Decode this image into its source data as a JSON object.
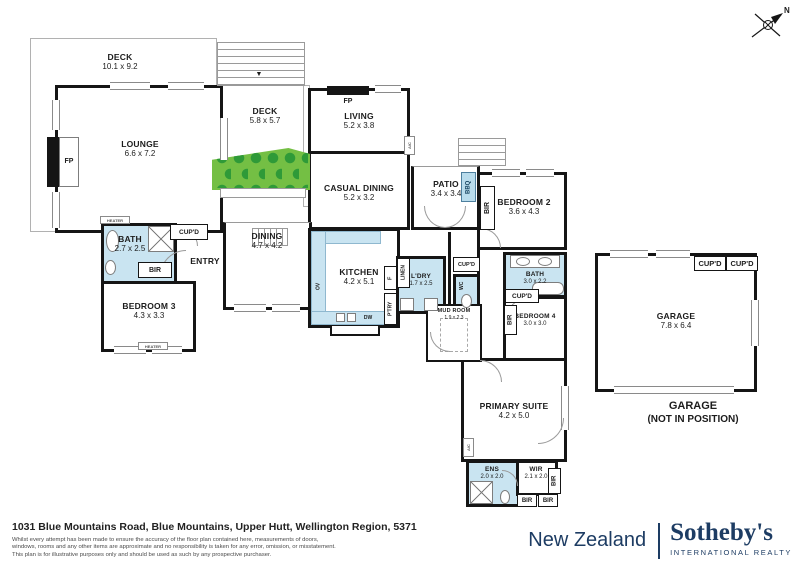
{
  "compass": {
    "north_label": "N"
  },
  "rooms": {
    "deck_main": {
      "name": "DECK",
      "dims": "10.1 x 9.2"
    },
    "lounge": {
      "name": "LOUNGE",
      "dims": "6.6 x 7.2"
    },
    "deck_upper": {
      "name": "DECK",
      "dims": "5.8 x 5.7"
    },
    "living": {
      "name": "LIVING",
      "dims": "5.2 x 3.8"
    },
    "casual_dining": {
      "name": "CASUAL DINING",
      "dims": "5.2 x 3.2"
    },
    "patio": {
      "name": "PATIO",
      "dims": "3.4 x 3.4"
    },
    "bedroom2": {
      "name": "BEDROOM 2",
      "dims": "3.6 x 4.3"
    },
    "bath2": {
      "name": "BATH",
      "dims": "3.0 x 2.2"
    },
    "bedroom4": {
      "name": "BEDROOM 4",
      "dims": "3.0 x 3.0"
    },
    "primary_suite": {
      "name": "PRIMARY SUITE",
      "dims": "4.2 x 5.0"
    },
    "ensuite": {
      "name": "ENS",
      "dims": "2.0 x 2.0"
    },
    "wir": {
      "name": "WIR",
      "dims": "2.1 x 2.0"
    },
    "garage": {
      "name": "GARAGE",
      "dims": "7.8 x 6.4"
    },
    "bath1": {
      "name": "BATH",
      "dims": "2.7 x 2.5"
    },
    "entry": {
      "name": "ENTRY"
    },
    "bedroom3": {
      "name": "BEDROOM 3",
      "dims": "4.3 x 3.3"
    },
    "dining": {
      "name": "DINING",
      "dims": "4.7 x 4.2"
    },
    "kitchen": {
      "name": "KITCHEN",
      "dims": "4.2 x 5.1"
    },
    "laundry": {
      "name": "L'DRY",
      "dims": "1.7 x 2.5"
    },
    "mud_room": {
      "name": "MUD ROOM",
      "dims": "1.9 x 2.3"
    }
  },
  "garage_note": {
    "line1": "GARAGE",
    "line2": "(NOT IN POSITION)"
  },
  "tags": {
    "fp": "FP",
    "cupd": "CUP'D",
    "bir": "BIR",
    "bbq": "BBQ",
    "ov": "OV",
    "dw": "DW",
    "fridge": "F",
    "pantry": "P'TRY",
    "linen": "LINEN",
    "wc": "WC",
    "ac": "A/C",
    "heater": "HEATER"
  },
  "footer": {
    "address": "1031 Blue Mountains Road, Blue Mountains, Upper Hutt, Wellington Region, 5371",
    "disclaimer_line1": "Whilst every attempt has been made to ensure the accuracy of the floor plan contained here, measurements of doors,",
    "disclaimer_line2": "windows, rooms and any other items are approximate and no responsibility is taken for any error, omission, or misstatement.",
    "disclaimer_line3": "This plan is for illustrative purposes only and should be used as such by any prospective purchaser."
  },
  "brand": {
    "region": "New Zealand",
    "name": "Sotheby's",
    "tagline": "INTERNATIONAL REALTY"
  },
  "colors": {
    "wall": "#151515",
    "wet_room_fill": "#c9e4f1",
    "planter_green": "#74bf44",
    "tree_green": "#2f9a38",
    "brand_navy": "#1d3c63"
  }
}
